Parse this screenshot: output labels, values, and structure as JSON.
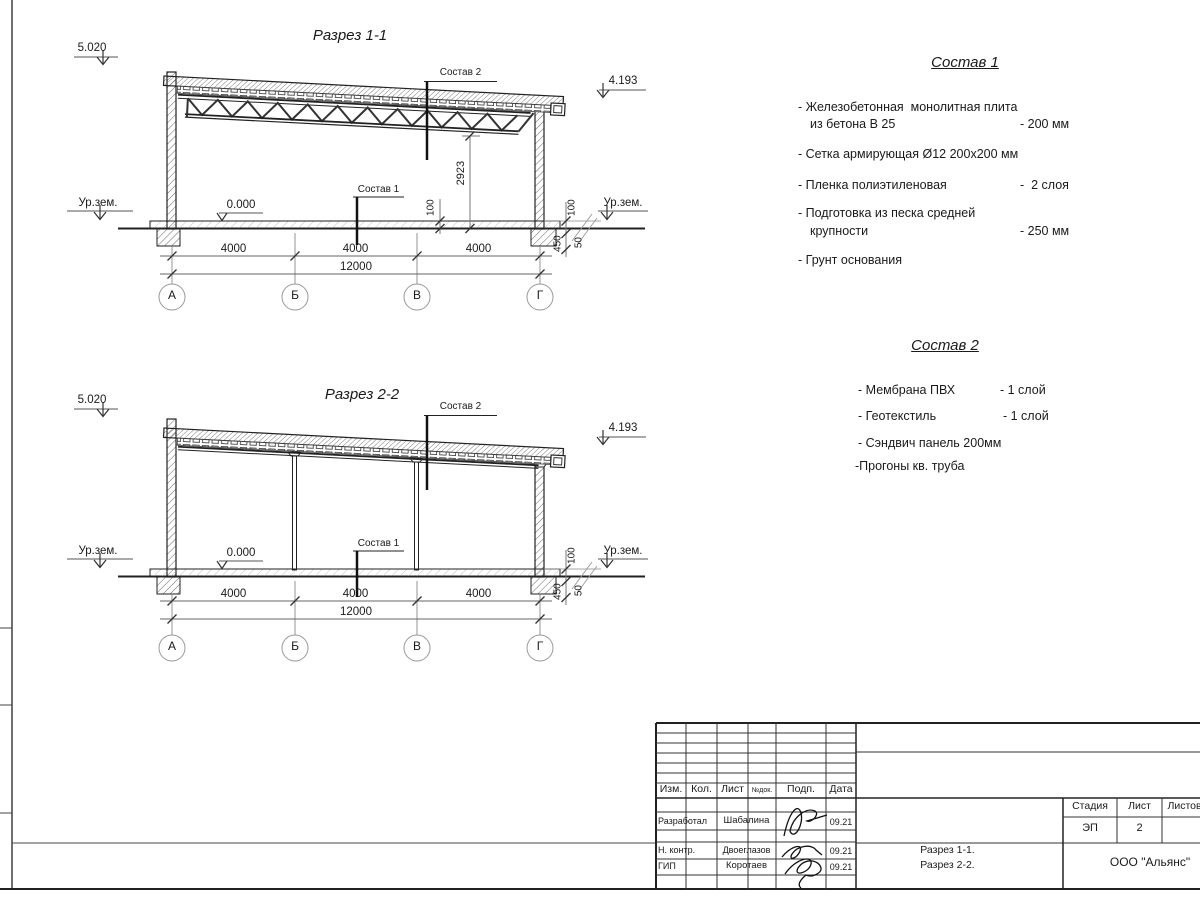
{
  "section1": {
    "title": "Разрез 1-1",
    "elev_left": "5.020",
    "elev_right": "4.193",
    "ground_left": "Ур.зем.",
    "ground_right": "Ур.зем.",
    "zero_mark": "0.000",
    "leader_top": "Состав 2",
    "leader_floor": "Состав 1",
    "dim_height": "2923",
    "dim_floor_100": "100",
    "dim_r100": "100",
    "dim_r450": "450",
    "dim_r50": "50",
    "spans": [
      "4000",
      "4000",
      "4000"
    ],
    "total": "12000",
    "axes": [
      "А",
      "Б",
      "В",
      "Г"
    ]
  },
  "section2": {
    "title": "Разрез 2-2",
    "elev_left": "5.020",
    "elev_right": "4.193",
    "ground_left": "Ур.зем.",
    "ground_right": "Ур.зем.",
    "zero_mark": "0.000",
    "leader_top": "Состав 2",
    "leader_floor": "Состав 1",
    "dim_r100": "100",
    "dim_r450": "450",
    "dim_r50": "50",
    "spans": [
      "4000",
      "4000",
      "4000"
    ],
    "total": "12000",
    "axes": [
      "А",
      "Б",
      "В",
      "Г"
    ]
  },
  "sostav1": {
    "title": "Состав 1",
    "items": [
      {
        "l1": "- Железобетонная  монолитная плита",
        "l2": "из бетона В 25",
        "val": "- 200 мм"
      },
      {
        "l1": "- Сетка армирующая Ø12 200х200 мм",
        "l2": "",
        "val": ""
      },
      {
        "l1": "- Пленка полиэтиленовая",
        "l2": "",
        "val": "-  2 слоя"
      },
      {
        "l1": "- Подготовка из песка средней",
        "l2": "крупности",
        "val": "- 250 мм"
      },
      {
        "l1": "- Грунт основания",
        "l2": "",
        "val": ""
      }
    ]
  },
  "sostav2": {
    "title": "Состав 2",
    "items": [
      {
        "l1": "- Мембрана ПВХ",
        "val": "- 1 слой"
      },
      {
        "l1": "- Геотекстиль",
        "val": "- 1 слой"
      },
      {
        "l1": "- Сэндвич панель 200мм",
        "val": ""
      },
      {
        "l1": "-Прогоны кв. труба",
        "val": ""
      }
    ]
  },
  "titleblock": {
    "cols": {
      "izm": "Изм.",
      "kol": "Кол.",
      "list": "Лист",
      "ndok": "№док.",
      "podp": "Подп.",
      "data": "Дата"
    },
    "rows": [
      {
        "role": "Разработал",
        "name": "Шабалина",
        "date": "09.21"
      },
      {
        "role": "Н. контр.",
        "name": "Двоеглазов",
        "date": "09.21"
      },
      {
        "role": "ГИП",
        "name": "Коротаев",
        "date": "09.21"
      }
    ],
    "stage_label": "Стадия",
    "sheet_label": "Лист",
    "sheets_label": "Листов",
    "stage": "ЭП",
    "sheet_num": "2",
    "title_line1": "Разрез 1-1.",
    "title_line2": "Разрез 2-2.",
    "company": "ООО \"Альянс\""
  }
}
